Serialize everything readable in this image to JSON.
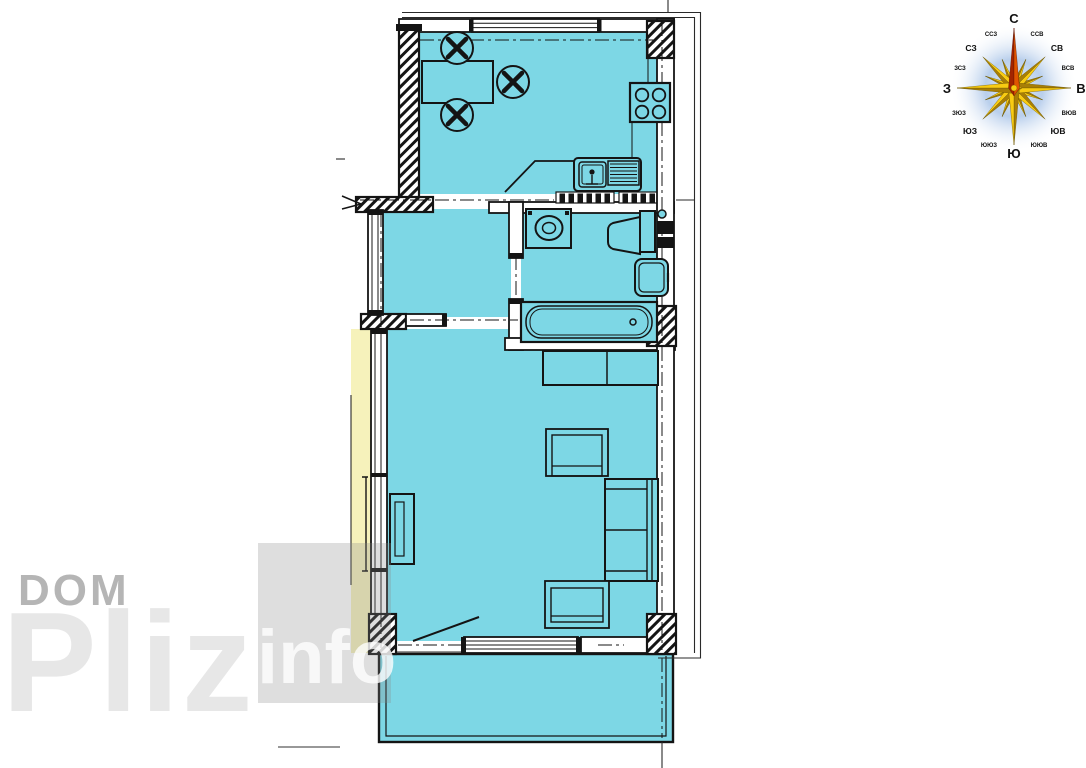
{
  "colors": {
    "room-fill": "#7dd7e5",
    "accent-yellow": "#f6f2bb",
    "wall-color": "#141414",
    "compass-gold-light": "#f8cb12",
    "compass-gold-dark": "#a87e06",
    "compass-north-light": "#e05500",
    "compass-north-dark": "#a32400",
    "compass-glow": "#b9cfec"
  },
  "watermark": {
    "line1": "DOM",
    "line2": "Pliz",
    "line3": "info"
  },
  "compass": {
    "labels": [
      {
        "text": "С"
      },
      {
        "text": "Ю"
      },
      {
        "text": "З"
      },
      {
        "text": "В"
      },
      {
        "text": "СЗ"
      },
      {
        "text": "СВ"
      },
      {
        "text": "ЮЗ"
      },
      {
        "text": "ЮВ"
      },
      {
        "text": "ССЗ"
      },
      {
        "text": "ССВ"
      },
      {
        "text": "ЗСЗ"
      },
      {
        "text": "ВСВ"
      },
      {
        "text": "ЗЮЗ"
      },
      {
        "text": "ВЮВ"
      },
      {
        "text": "ЮЮЗ"
      },
      {
        "text": "ЮЮВ"
      }
    ]
  },
  "plan": {
    "rooms": [
      "kitchen",
      "hall",
      "bathroom",
      "living-room",
      "balcony"
    ],
    "fixtures": [
      "dining-table",
      "chairs",
      "stove",
      "kitchen-sink",
      "drainboard",
      "washing-machine",
      "toilet",
      "washbasin",
      "bathtub",
      "dresser",
      "armchair",
      "sofa",
      "wardrobe"
    ]
  }
}
